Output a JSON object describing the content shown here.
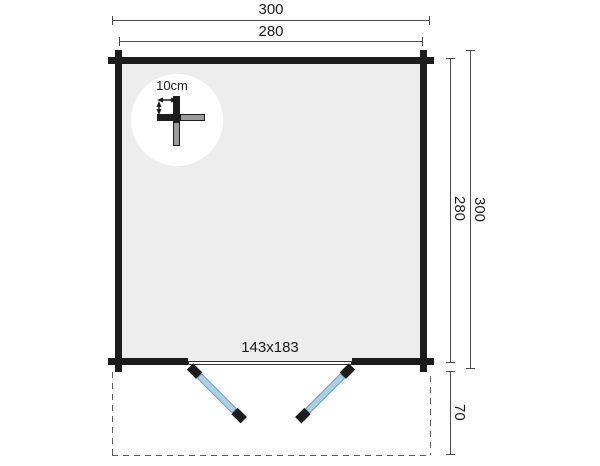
{
  "plan": {
    "name": "log-cabin-floor-plan",
    "dims": {
      "top_outer": "300",
      "top_inner": "280",
      "right_inner": "280",
      "right_outer": "300",
      "terrace_depth": "70",
      "door_size": "143x183",
      "wall_thickness": "10cm"
    }
  },
  "colors": {
    "wall": "#1c1c1c",
    "floor": "#ededed",
    "door": "#a9d0e6",
    "door-edge": "#6f9fb8",
    "dim-line": "#4a4a4a",
    "dash": "#5a5a5a",
    "log-end": "#9b9b9b",
    "text": "#1a1a1a",
    "bg": "#ffffff"
  }
}
